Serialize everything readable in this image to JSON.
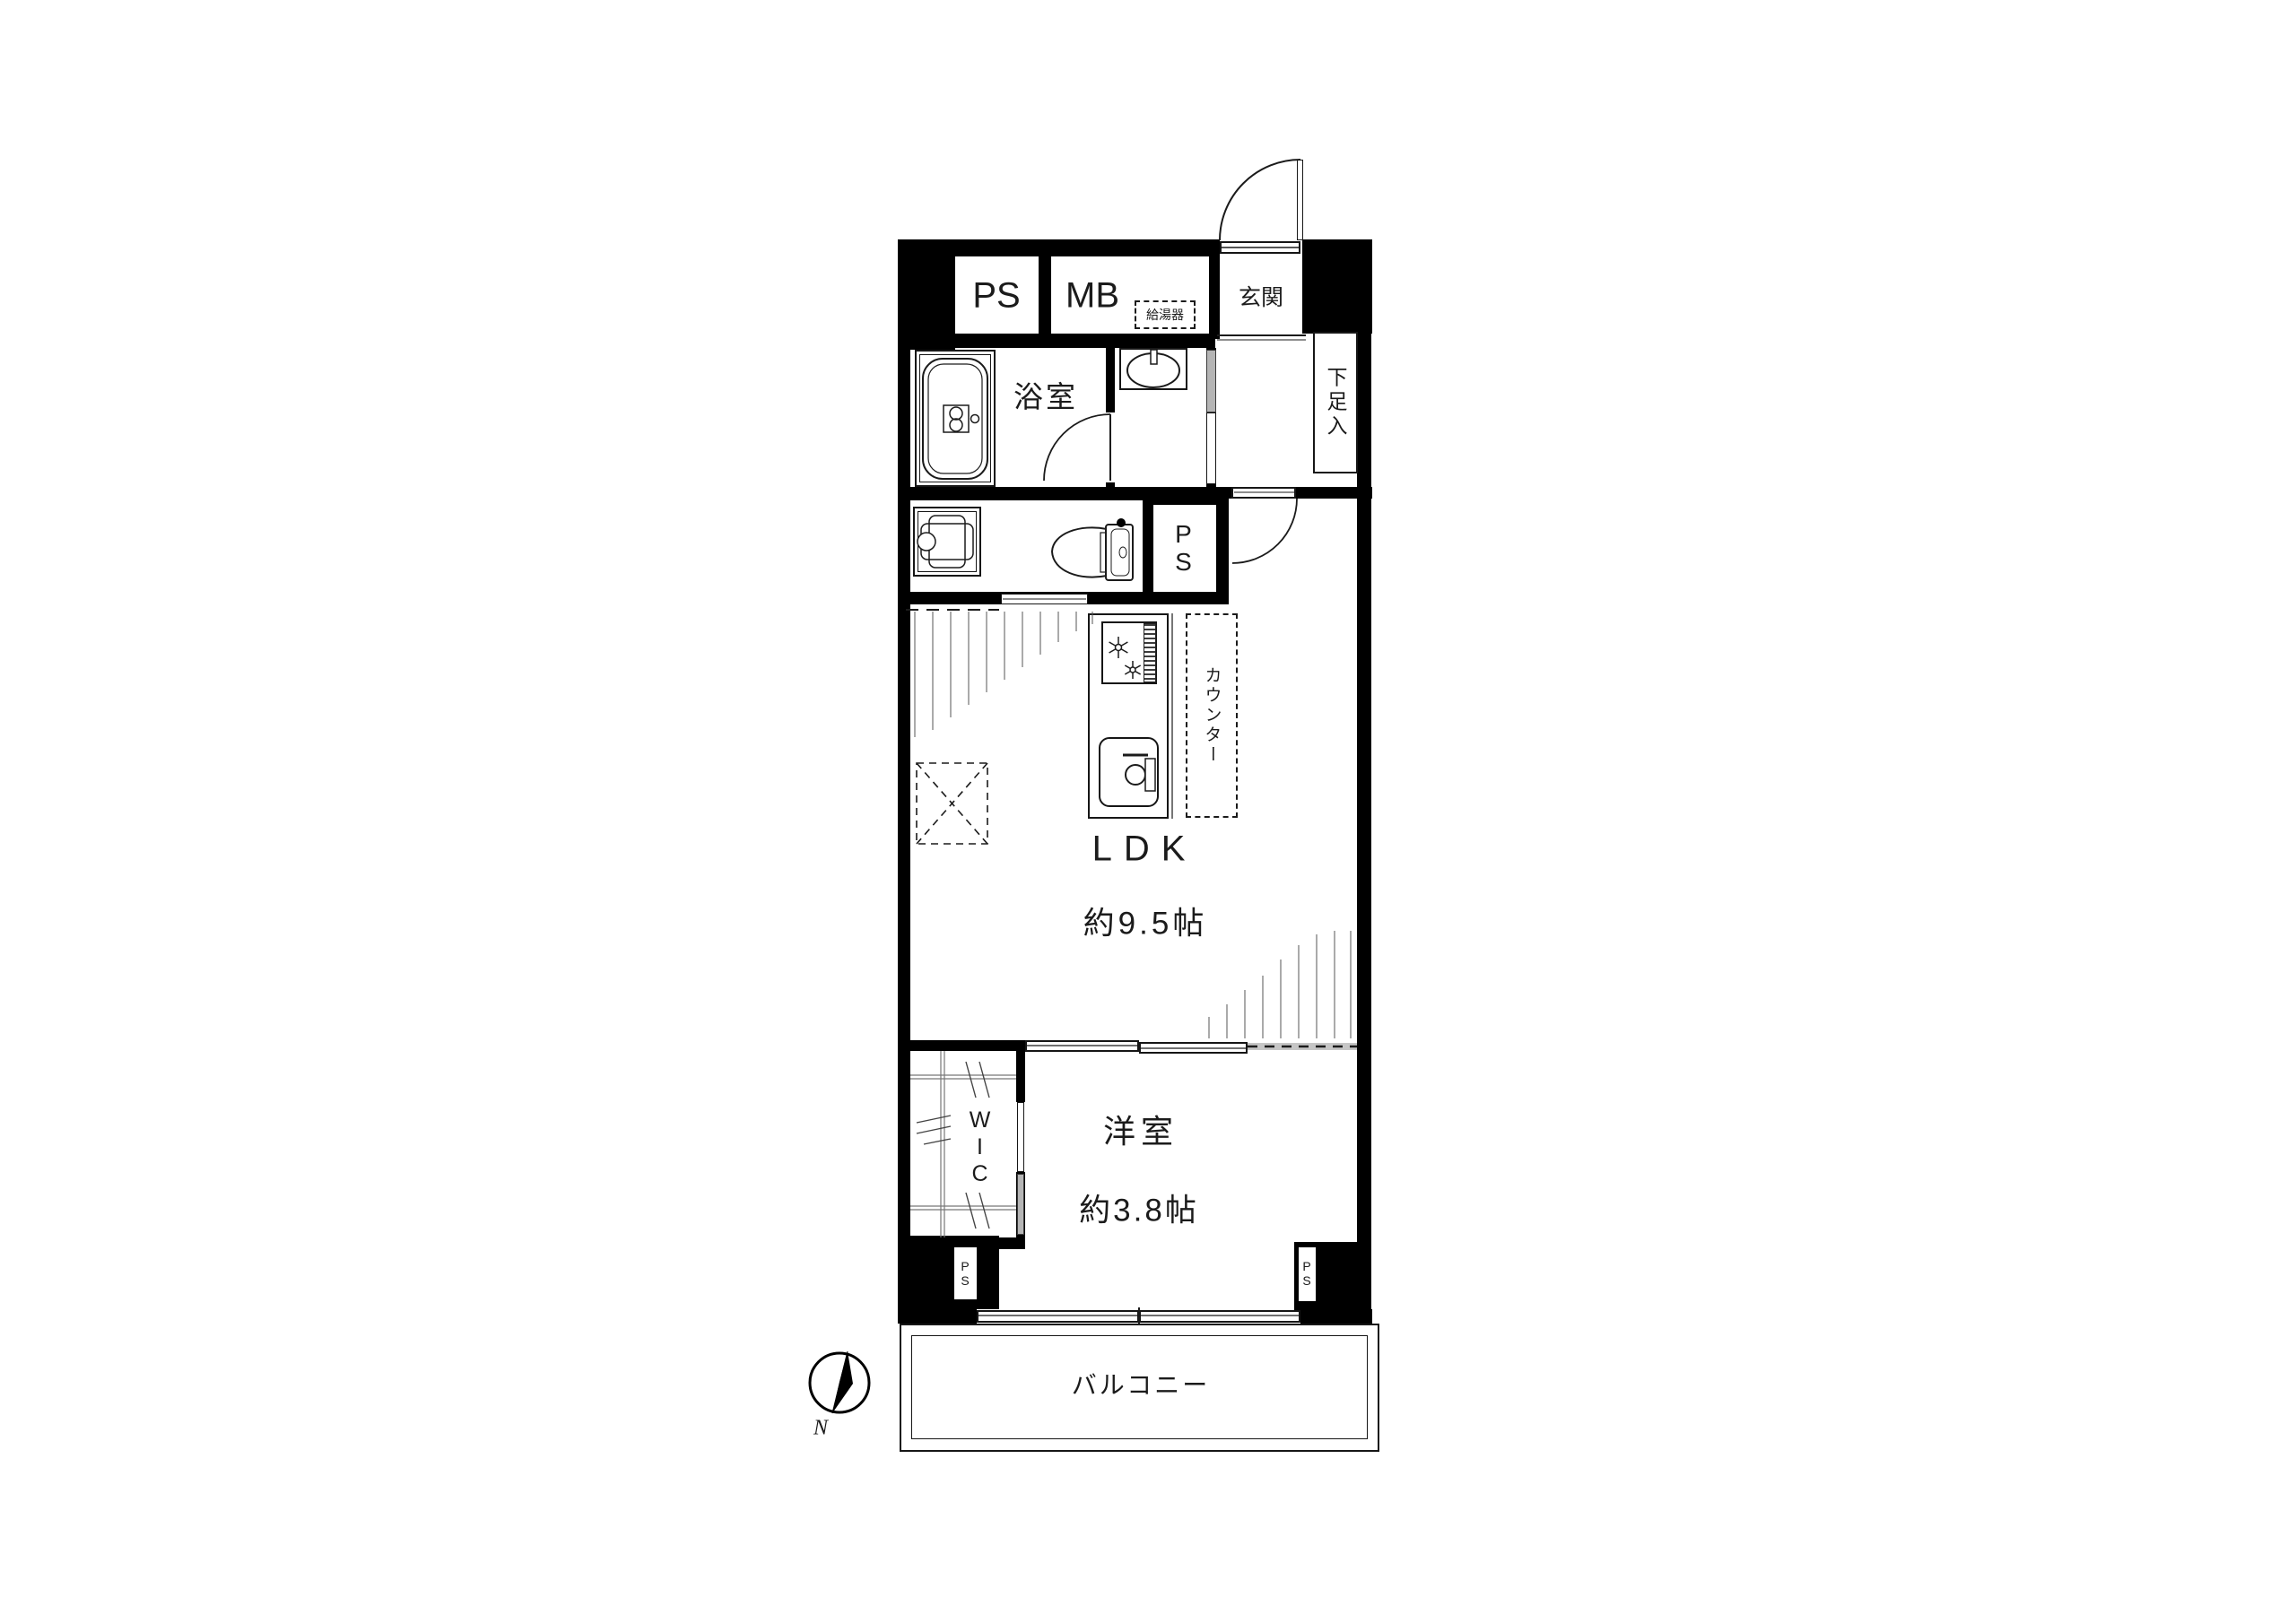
{
  "document": {
    "type": "floor-plan",
    "style": "black-and-white Japanese apartment layout"
  },
  "labels": {
    "ps_top": "PS",
    "mb": "MB",
    "water_heater": "給湯器",
    "entrance": "玄関",
    "shoe_cabinet": "下足入",
    "bathroom": "浴室",
    "ps_middle": "PS",
    "counter": "カウンター",
    "ldk": "LDK",
    "ldk_size": "約9.5帖",
    "wic": "WIC",
    "bedroom": "洋室",
    "bedroom_size": "約3.8帖",
    "ps_bottom_left": "PS",
    "ps_bottom_right": "PS",
    "balcony": "バルコニー",
    "compass_north": "N"
  },
  "rooms": [
    {
      "name": "LDK",
      "size": "約9.5帖"
    },
    {
      "name": "洋室",
      "size": "約3.8帖"
    },
    {
      "name": "浴室"
    },
    {
      "name": "玄関"
    },
    {
      "name": "WIC"
    },
    {
      "name": "バルコニー"
    }
  ],
  "fixtures": [
    "bathtub",
    "washbasin",
    "toilet",
    "washing-machine-pan",
    "gas-stove",
    "kitchen-sink",
    "water-heater",
    "refrigerator-space",
    "kitchen-counter",
    "shoe-cabinet",
    "compass"
  ],
  "colors": {
    "wall": "#000000",
    "line": "#1b1b1b",
    "sliding_panel_gray": "#b5b5b5",
    "background": "#ffffff"
  }
}
